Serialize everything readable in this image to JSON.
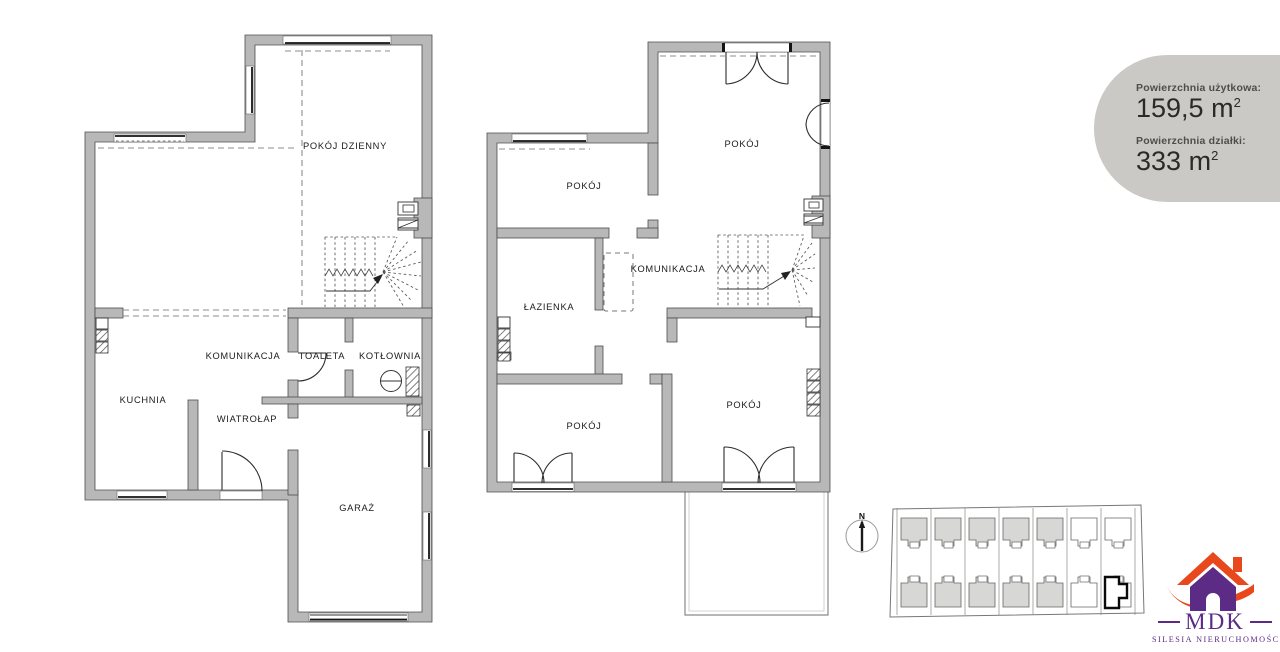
{
  "info_badge": {
    "background": "#cac9c5",
    "items": [
      {
        "label": "Powierzchnia użytkowa:",
        "value": "159,5",
        "unit": "m",
        "exponent": "2"
      },
      {
        "label": "Powierzchnia działki:",
        "value": "333",
        "unit": "m",
        "exponent": "2"
      }
    ]
  },
  "plans": {
    "ground_floor": {
      "rooms": {
        "living": "POKÓJ DZIENNY",
        "hall": "KOMUNIKACJA",
        "toilet": "TOALETA",
        "boiler": "KOTŁOWNIA",
        "kitchen": "KUCHNIA",
        "vestibule": "WIATROŁAP",
        "garage": "GARAŻ"
      }
    },
    "upper_floor": {
      "rooms": {
        "room_top_left": "POKÓJ",
        "room_top_right": "POKÓJ",
        "hall": "KOMUNIKACJA",
        "bathroom": "ŁAZIENKA",
        "room_bottom_left": "POKÓJ",
        "room_bottom_right": "POKÓJ"
      }
    }
  },
  "site_plan": {
    "compass": "N",
    "rows": 2,
    "units_per_row": 7,
    "shaded_units_per_row": 5,
    "highlighted_unit": "bottom row, rightmost"
  },
  "logo": {
    "title": "MDK",
    "subtitle": "SILESIA NIERUCHOMOŚCI",
    "purple": "#5b2b85",
    "orange": "#e8481c"
  }
}
